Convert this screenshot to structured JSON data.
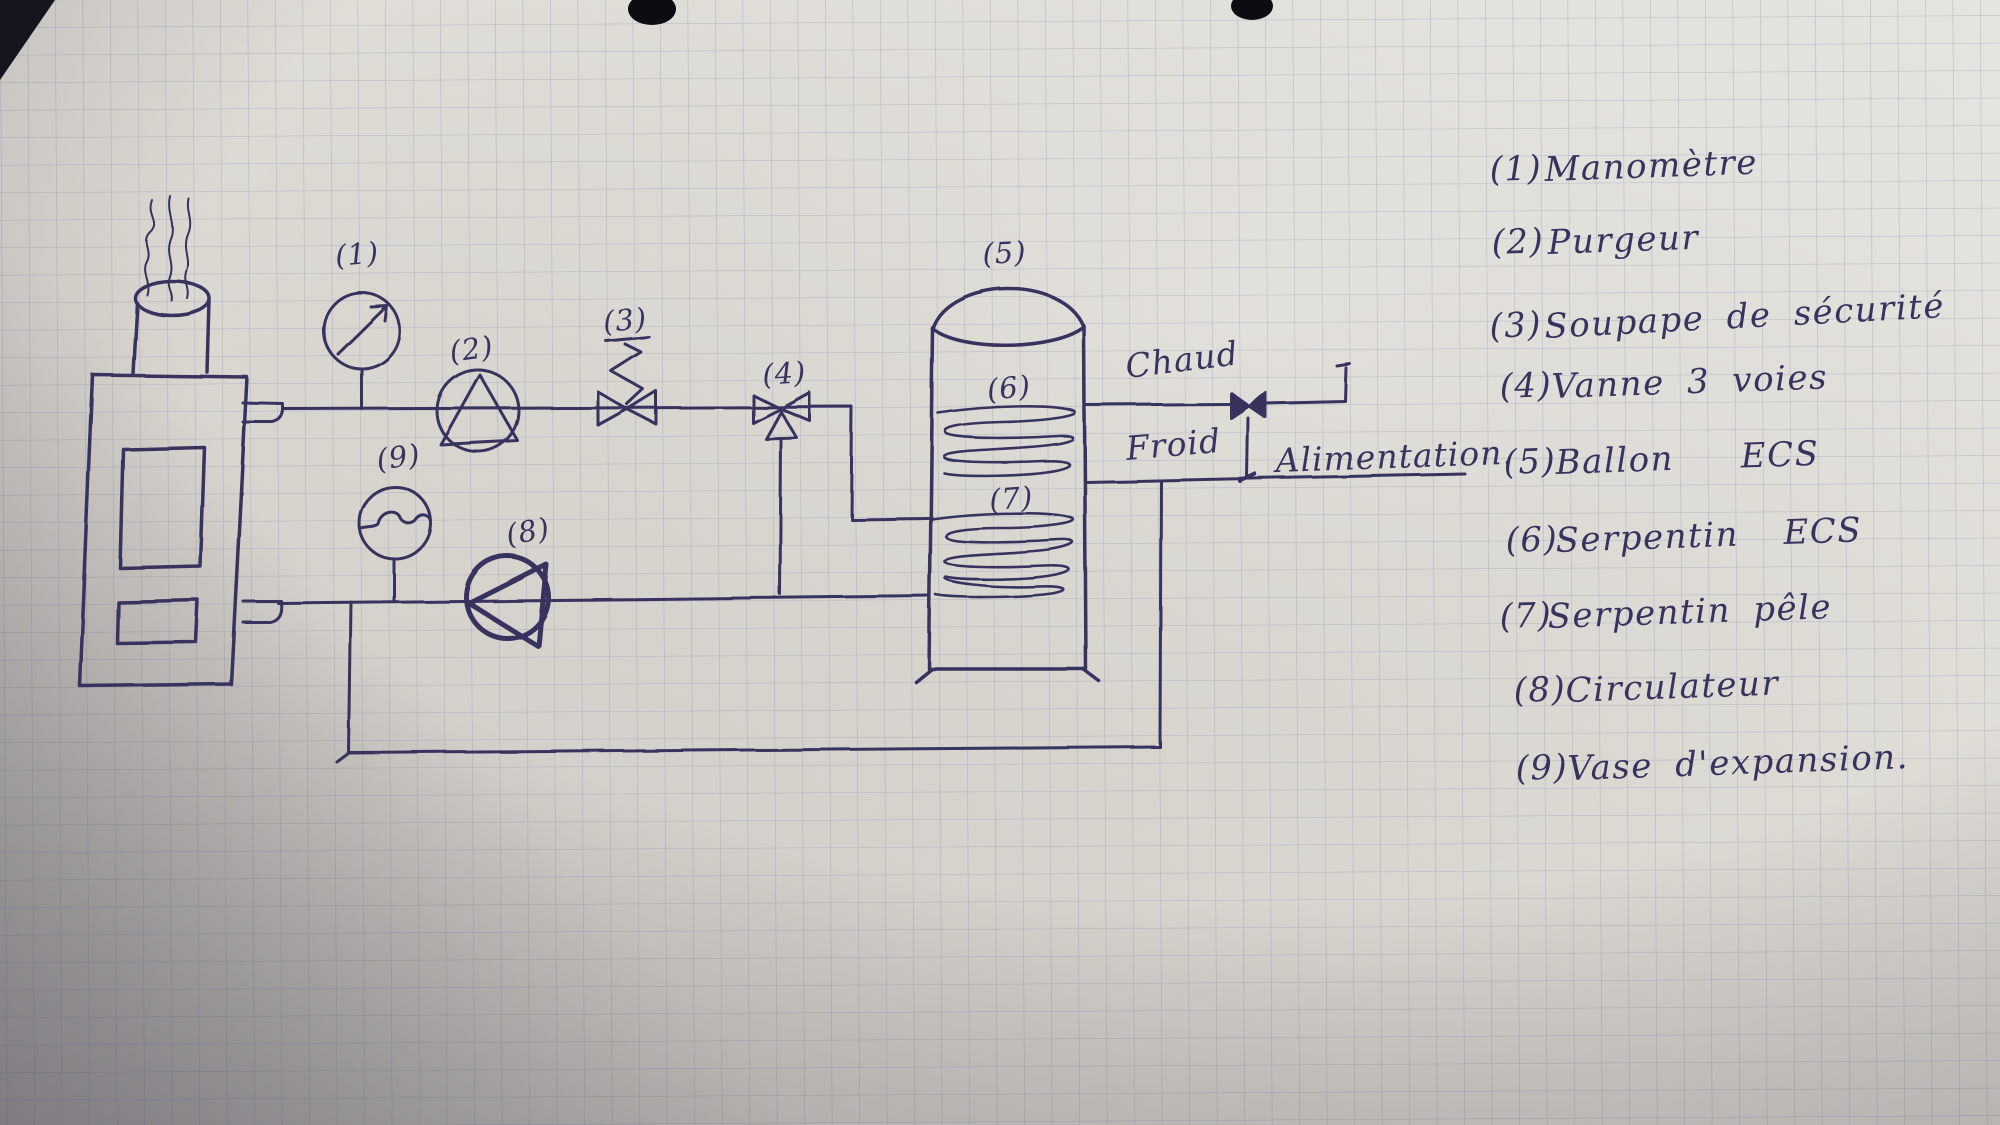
{
  "scene": {
    "description": "Hand-drawn heating / hot-water schematic on squared (quadrille) paper",
    "ink_color": "#39325e",
    "paper_color": "#dcd9d3",
    "grid_color": "#8f94c0"
  },
  "diagram": {
    "tags": {
      "t1": "(1)",
      "t2": "(2)",
      "t3": "(3)",
      "t4": "(4)",
      "t5": "(5)",
      "t6": "(6)",
      "t7": "(7)",
      "t8": "(8)",
      "t9": "(9)"
    },
    "flow_labels": {
      "chaud": "Chaud",
      "froid": "Froid",
      "alimentation": "Alimentation."
    }
  },
  "legend": {
    "items": [
      {
        "num": "(1)",
        "label": "Manomètre"
      },
      {
        "num": "(2)",
        "label": "Purgeur"
      },
      {
        "num": "(3)",
        "label": "Soupape de sécurité"
      },
      {
        "num": "(4)",
        "label": "Vanne 3 voies"
      },
      {
        "num": "(5)",
        "label": "Ballon   ECS"
      },
      {
        "num": "(6)",
        "label": "Serpentin  ECS"
      },
      {
        "num": "(7)",
        "label": "Serpentin pêle"
      },
      {
        "num": "(8)",
        "label": "Circulateur"
      },
      {
        "num": "(9)",
        "label": "Vase d'expansion."
      }
    ]
  }
}
